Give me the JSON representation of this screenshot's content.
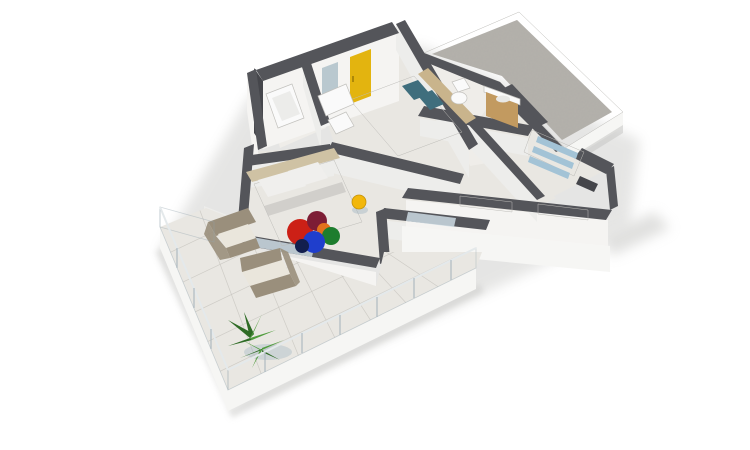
{
  "scene": {
    "type": "3d-floor-plan-render",
    "background": "#ffffff",
    "description": "Isometric 3D render of an apartment floor plan: two bedrooms, two bathrooms, hallway with staircase, gravel flat roof at rear and a large wrap-around terrace with glass balustrade, shown on a white background"
  },
  "rooms": [
    "bedroom-1",
    "bedroom-2",
    "bathroom-1",
    "bathroom-2",
    "hallway",
    "stair-room",
    "terrace",
    "flat-roof"
  ],
  "furniture": [
    "teal-double-bed",
    "gray-double-bed",
    "dressing-table",
    "chair",
    "wall-mirror",
    "yellow-door",
    "shower-tray",
    "toilet",
    "wood-vanity",
    "staircase",
    "round-rug",
    "yellow-stool",
    "terrace-armchair-1",
    "terrace-armchair-2",
    "potted-plant",
    "sliding-glass-doors"
  ],
  "colors": {
    "background": "#ffffff",
    "shadow": "#c7c7c5",
    "wall_top": "#54555a",
    "wall_dark": "#45464b",
    "wall_face": "#ededeb",
    "wall_face_bright": "#f5f4f2",
    "floor": "#e9e7e2",
    "floor_bath": "#efede9",
    "fascia": "#f6f6f4",
    "roof_rim": "#e9e8e4",
    "gravel": "#b5b2ac",
    "glass": "#b9cedb",
    "bed1_duvet": "#4f7f8c",
    "bed1_pillow": "#3f6e7d",
    "headboard_wood": "#c9b48c",
    "bed2_duvet": "#dcdbd8",
    "bed2_pillow": "#f0efed",
    "bed2_frame": "#cfc2a4",
    "bed2_fold": "#c6c5c2",
    "rug_red": "#cc2016",
    "rug_maroon": "#7d1d35",
    "rug_blue": "#1f3ecc",
    "rug_green": "#1d7d2e",
    "rug_orange": "#e2711c",
    "rug_navy": "#131f4e",
    "yellow_door": "#e3b40f",
    "stool_yellow": "#f2b70b",
    "wood": "#c29a60",
    "plant_dark": "#2e6b25",
    "plant_light": "#4f9c3c",
    "plant_shadow": "#8fa8bb",
    "chair_beige": "#9a8f7c",
    "chair_cushion": "#eae6dc",
    "stairs_blue": "#a3c3d6",
    "stairs_light": "#e6eef3",
    "fixture_white": "#fafafa",
    "door_glass": "#ccdbe3",
    "window_white": "#fbfbfa"
  }
}
